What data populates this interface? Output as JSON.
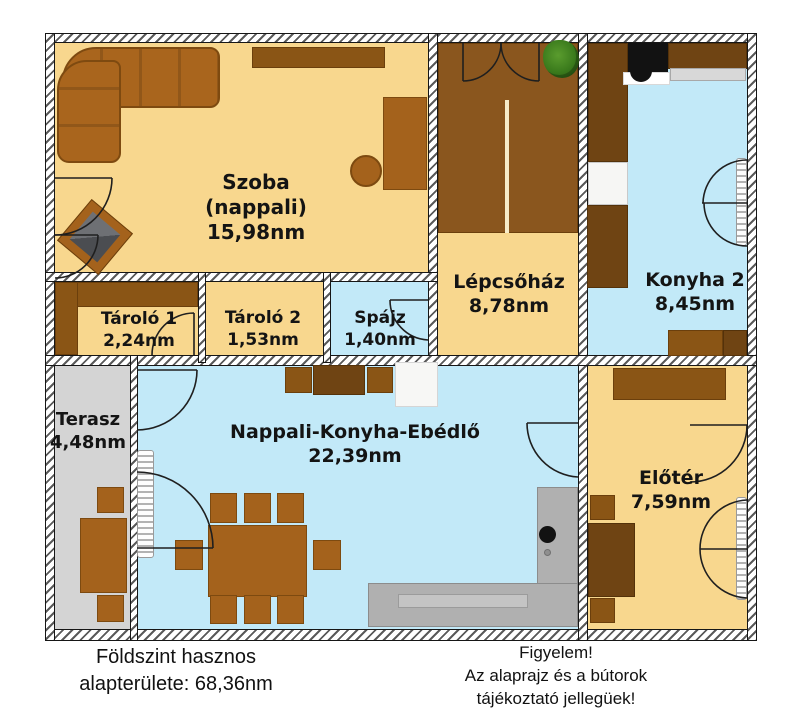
{
  "plan": {
    "rooms": [
      {
        "id": "szoba",
        "name": "Szoba",
        "sub": "(nappali)",
        "area": "15,98nm"
      },
      {
        "id": "lepcsohaz",
        "name": "Lépcsőház",
        "area": "8,78nm"
      },
      {
        "id": "konyha2",
        "name": "Konyha 2",
        "area": "8,45nm"
      },
      {
        "id": "tarolo1",
        "name": "Tároló 1",
        "area": "2,24nm"
      },
      {
        "id": "tarolo2",
        "name": "Tároló 2",
        "area": "1,53nm"
      },
      {
        "id": "spajz",
        "name": "Spájz",
        "area": "1,40nm"
      },
      {
        "id": "terasz",
        "name": "Terasz",
        "area": "4,48nm"
      },
      {
        "id": "nappali",
        "name": "Nappali-Konyha-Ebédlő",
        "area": "22,39nm"
      },
      {
        "id": "eloter",
        "name": "Előtér",
        "area": "7,59nm"
      }
    ],
    "total_area": "68,36nm"
  },
  "footer": {
    "left_line1": "Földszint hasznos",
    "left_line2": "alapterülete: 68,36nm",
    "right_line1": "Figyelem!",
    "right_line2": "Az alaprajz és a bútorok tájékoztató jellegüek!"
  },
  "colors": {
    "floor_orange": "#F8D78E",
    "floor_blue": "#C2E9F8",
    "floor_grey": "#D4D4D4",
    "furniture_brown": "#A4621C",
    "cabinet_dark": "#6F4413",
    "stairs_brown": "#8A561E",
    "label_text": "#141414"
  }
}
